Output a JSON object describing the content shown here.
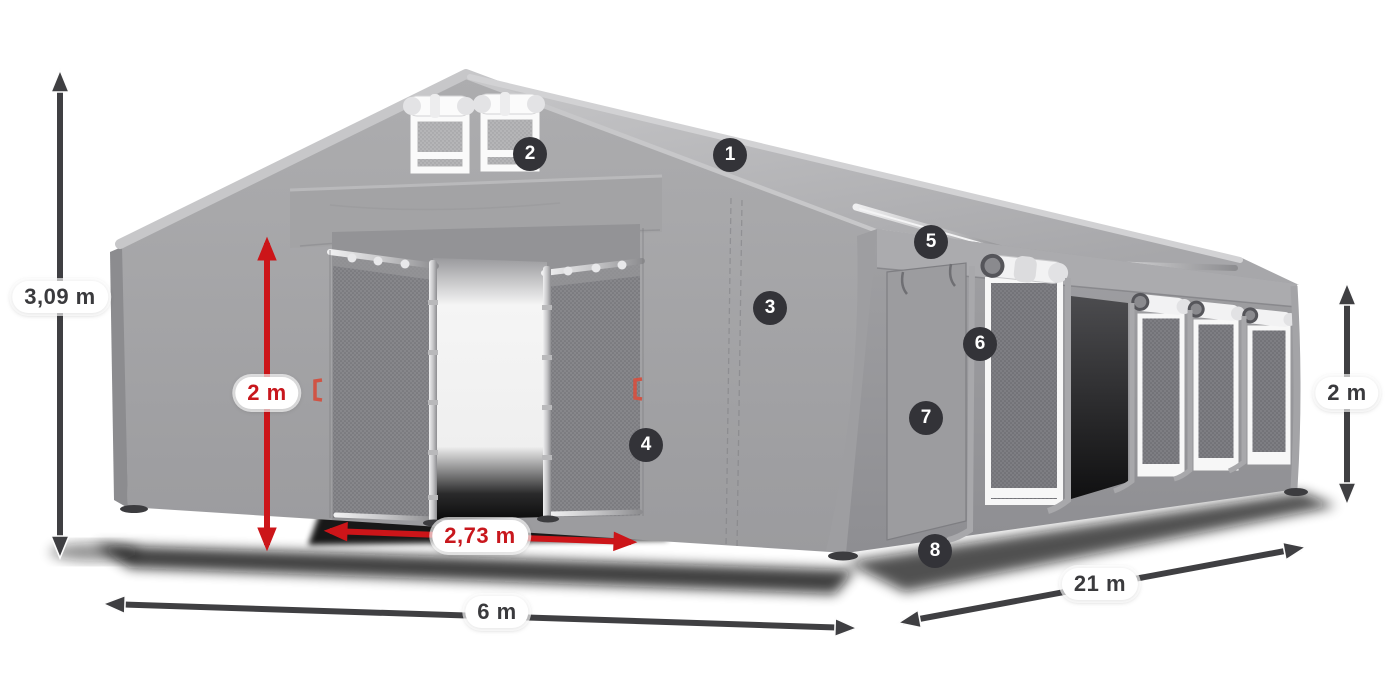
{
  "canvas": {
    "width": 1400,
    "height": 700,
    "background": "#ffffff"
  },
  "colors": {
    "arrow_dark": "#3f3f42",
    "arrow_red": "#cc1519",
    "label_text_dark": "#3a3a3d",
    "label_text_red": "#c8171d",
    "label_bg": "#ffffff",
    "badge_bg": "#333338",
    "badge_text": "#ffffff",
    "tent_roof": "#b8b8ba",
    "tent_front": "#a6a6a8",
    "tent_side": "#96969a",
    "window_frame": "#f7f7f7"
  },
  "badges": [
    {
      "number": "1",
      "x": 730,
      "y": 155
    },
    {
      "number": "2",
      "x": 530,
      "y": 154
    },
    {
      "number": "3",
      "x": 770,
      "y": 308
    },
    {
      "number": "4",
      "x": 646,
      "y": 445
    },
    {
      "number": "5",
      "x": 931,
      "y": 242
    },
    {
      "number": "6",
      "x": 980,
      "y": 344
    },
    {
      "number": "7",
      "x": 926,
      "y": 418
    },
    {
      "number": "8",
      "x": 935,
      "y": 551
    }
  ],
  "dimensions": [
    {
      "id": "total-height",
      "label": "3,09 m",
      "color": "dark",
      "x1": 60,
      "y1": 75,
      "x2": 60,
      "y2": 553,
      "lx": 60,
      "ly": 297
    },
    {
      "id": "door-height",
      "label": "2 m",
      "color": "red",
      "x1": 267,
      "y1": 243,
      "x2": 267,
      "y2": 545,
      "lx": 267,
      "ly": 393
    },
    {
      "id": "door-width",
      "label": "2,73 m",
      "color": "red",
      "x1": 330,
      "y1": 531,
      "x2": 631,
      "y2": 542,
      "lx": 480,
      "ly": 536
    },
    {
      "id": "tent-width",
      "label": "6 m",
      "color": "dark",
      "x1": 108,
      "y1": 604,
      "x2": 852,
      "y2": 628,
      "lx": 497,
      "ly": 612
    },
    {
      "id": "tent-length",
      "label": "21 m",
      "color": "dark",
      "x1": 903,
      "y1": 622,
      "x2": 1301,
      "y2": 548,
      "lx": 1100,
      "ly": 584
    },
    {
      "id": "side-height",
      "label": "2 m",
      "color": "dark",
      "x1": 1347,
      "y1": 288,
      "x2": 1347,
      "y2": 500,
      "lx": 1347,
      "ly": 393
    }
  ]
}
